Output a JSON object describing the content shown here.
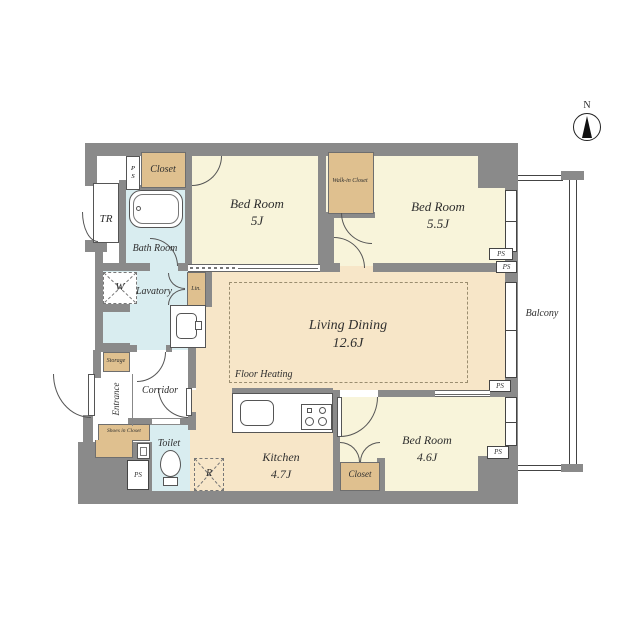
{
  "compass": {
    "north": "N"
  },
  "balcony": {
    "label": "Balcony"
  },
  "rooms": {
    "bedroom_5j": {
      "name": "Bed Room",
      "area": "5J"
    },
    "bedroom_55j": {
      "name": "Bed Room",
      "area": "5.5J"
    },
    "bedroom_46j": {
      "name": "Bed Room",
      "area": "4.6J"
    },
    "living_dining": {
      "name": "Living Dining",
      "area": "12.6J",
      "note": "Floor Heating"
    },
    "kitchen": {
      "name": "Kitchen",
      "area": "4.7J"
    },
    "bath": {
      "name": "Bath Room"
    },
    "lavatory": {
      "name": "Lavatory"
    },
    "toilet": {
      "name": "Toilet"
    },
    "corridor": {
      "name": "Corridor"
    },
    "entrance": {
      "name": "Entrance"
    }
  },
  "storage": {
    "closet_top": "Closet",
    "walk_in_closet": "Walk-in Closet",
    "closet_bottom": "Closet",
    "storage_room": "Storage",
    "shoes_in_closet": "Shoes in Closet",
    "linen": "Lin.",
    "trunk_room": "TR"
  },
  "fixtures": {
    "washer": "W",
    "refrigerator": "R"
  },
  "badges": {
    "ps": "PS"
  },
  "colors": {
    "wall": "#8a8a8a",
    "bedroom_floor": "#f8f4da",
    "ldk_floor": "#f7e6c8",
    "wet_area_floor": "#d9edf0",
    "closet_fill": "#dfc08f"
  }
}
